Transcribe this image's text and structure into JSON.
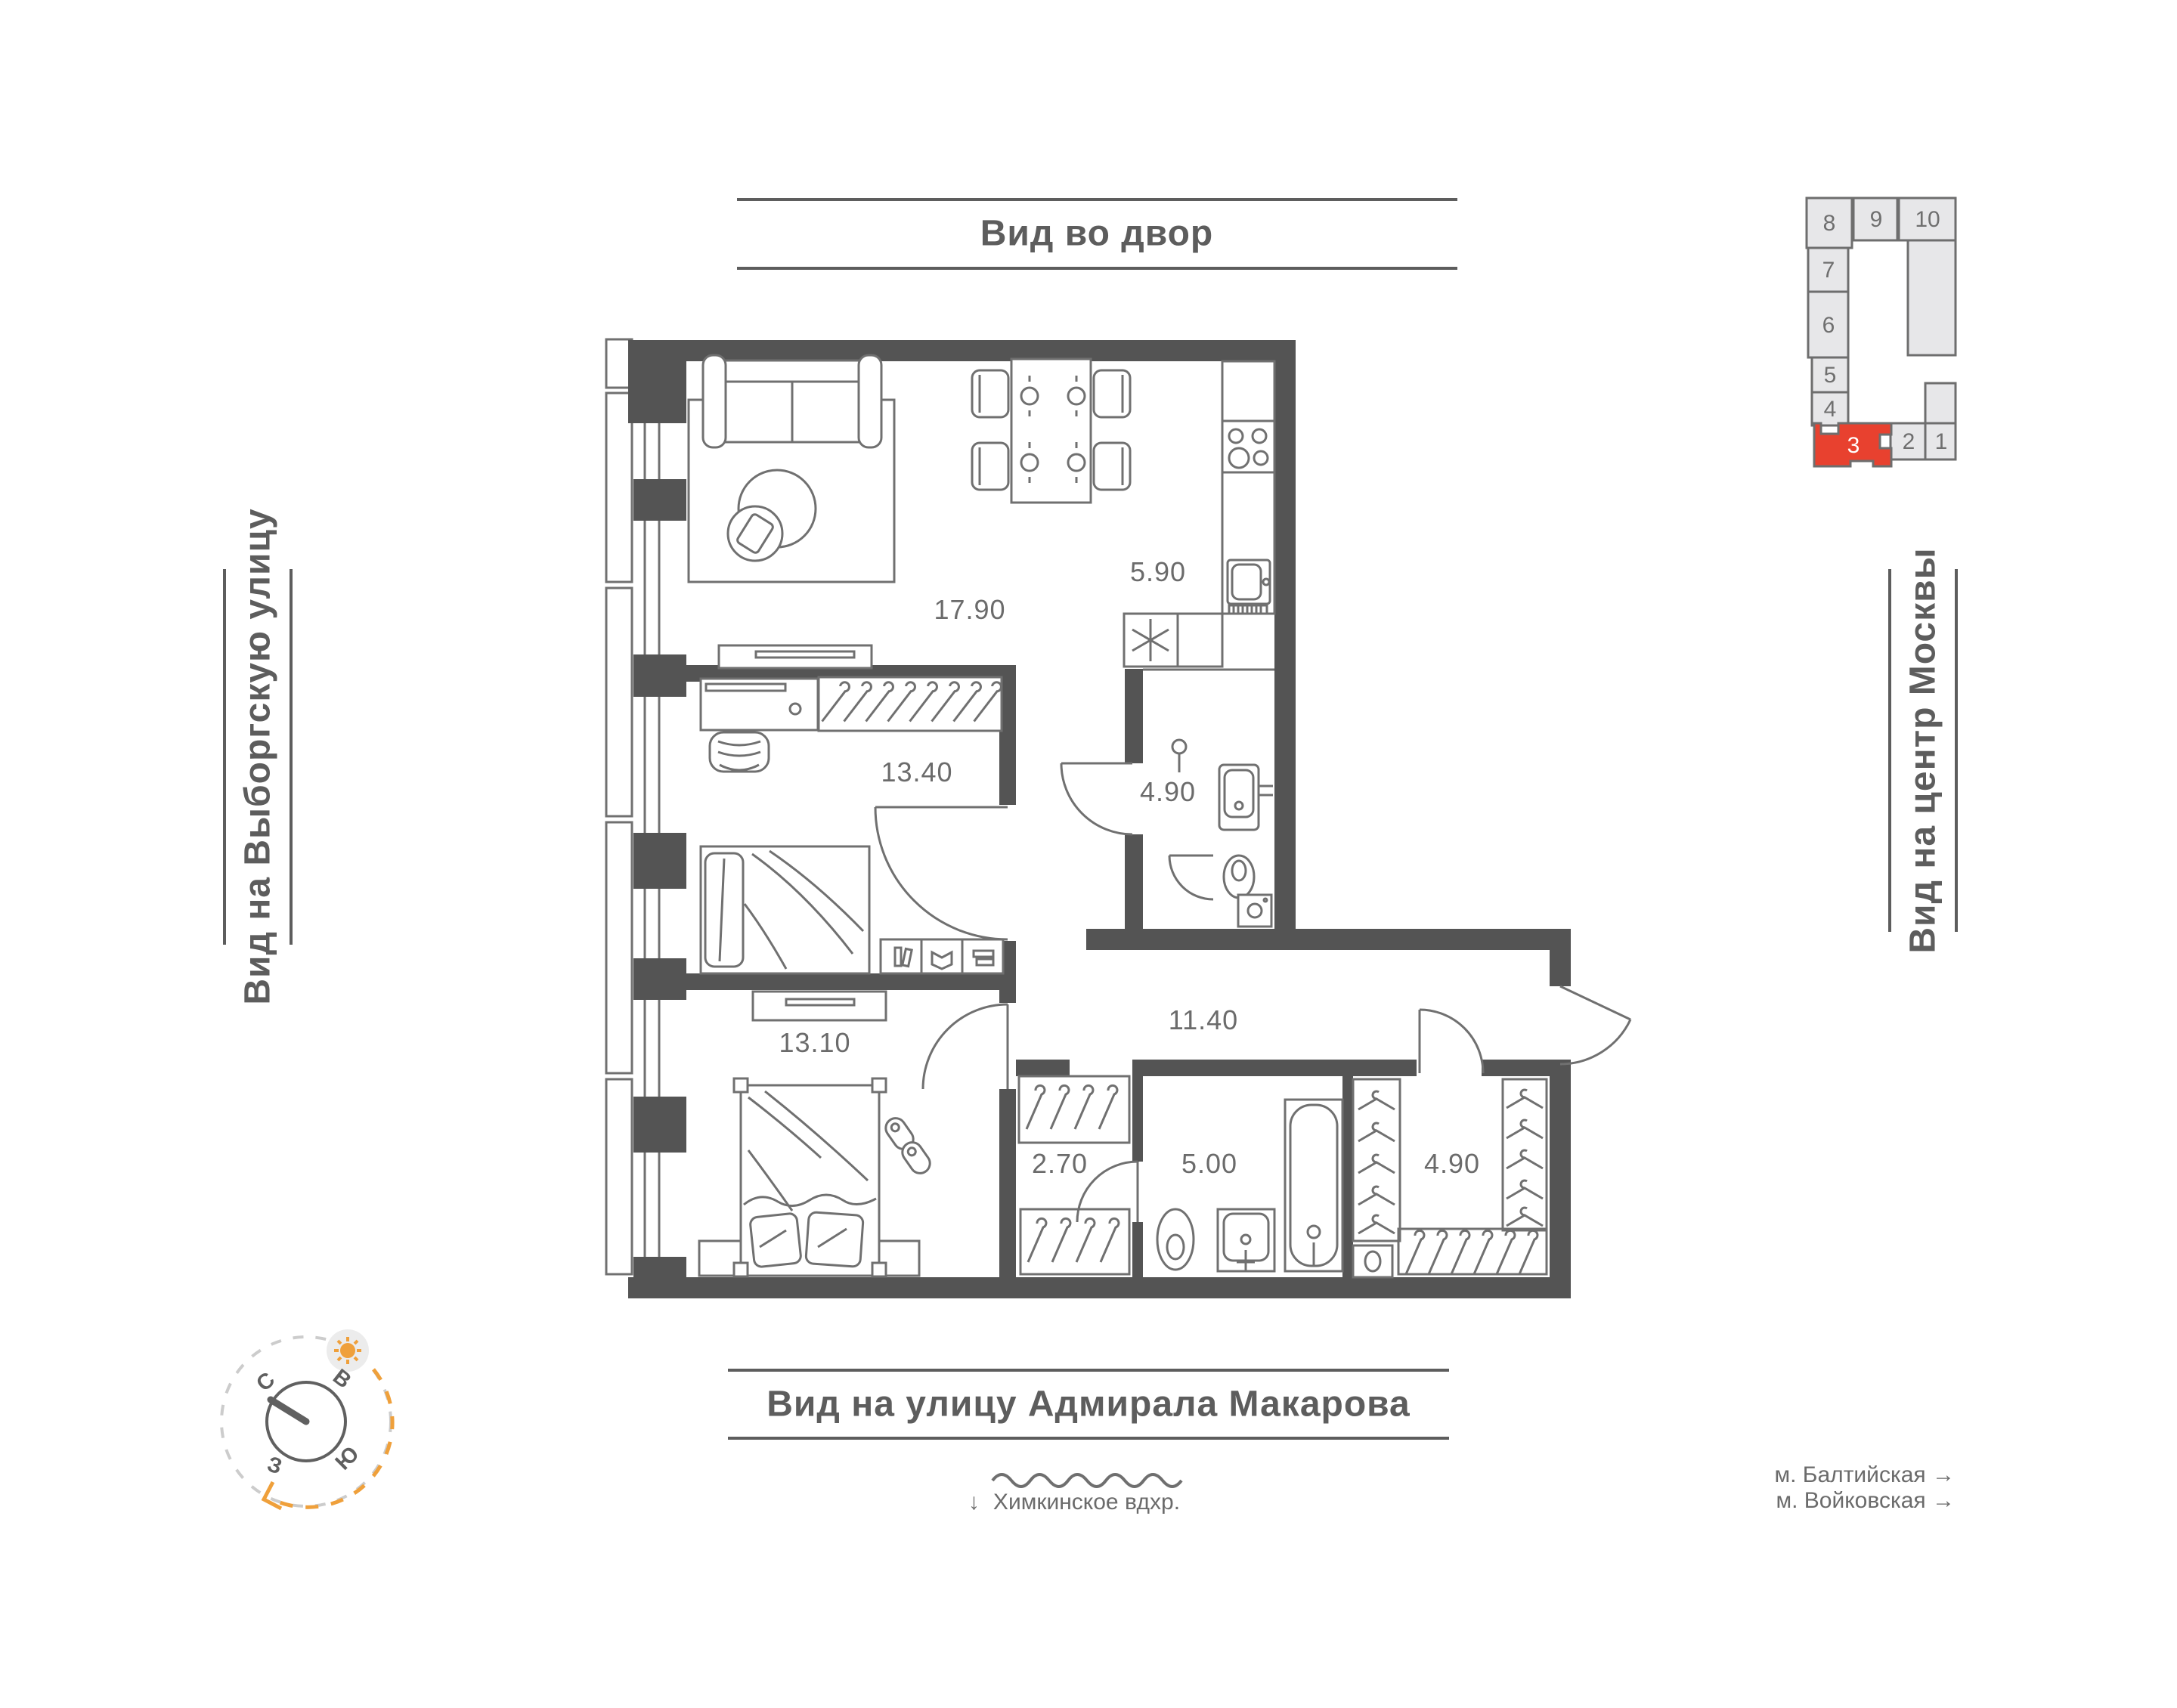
{
  "view_labels": {
    "top": "Вид во двор",
    "left": "Вид на Выборгскую улицу",
    "right": "Вид на центр Москвы",
    "bottom": "Вид на улицу Адмирала Макарова"
  },
  "landmarks": {
    "reservoir_arrow": "↓",
    "reservoir": "Химкинское вдхр.",
    "metro_1": "м. Балтийская →",
    "metro_2": "м. Войковская →"
  },
  "rooms": [
    {
      "name": "living-room",
      "area": "17.90"
    },
    {
      "name": "kitchen",
      "area": "5.90"
    },
    {
      "name": "bedroom-1",
      "area": "13.40"
    },
    {
      "name": "bathroom-1",
      "area": "4.90"
    },
    {
      "name": "hallway",
      "area": "11.40"
    },
    {
      "name": "bedroom-2",
      "area": "13.10"
    },
    {
      "name": "closet",
      "area": "2.70"
    },
    {
      "name": "bathroom-2",
      "area": "5.00"
    },
    {
      "name": "wardrobe",
      "area": "4.90"
    }
  ],
  "compass": {
    "north": "С",
    "east": "В",
    "south": "Ю",
    "west": "З"
  },
  "minimap": {
    "selected_unit": "3",
    "units": [
      {
        "label": "8"
      },
      {
        "label": "9"
      },
      {
        "label": "10"
      },
      {
        "label": "7"
      },
      {
        "label": "6"
      },
      {
        "label": "5"
      },
      {
        "label": "4"
      },
      {
        "label": "3"
      },
      {
        "label": "2"
      },
      {
        "label": "1"
      }
    ]
  },
  "colors": {
    "wall": "#545454",
    "outline": "#707070",
    "accent_red": "#e8412f",
    "accent_orange": "#efa03b",
    "minimap_fill": "#e7e7e9",
    "text": "#6b6b6b"
  }
}
